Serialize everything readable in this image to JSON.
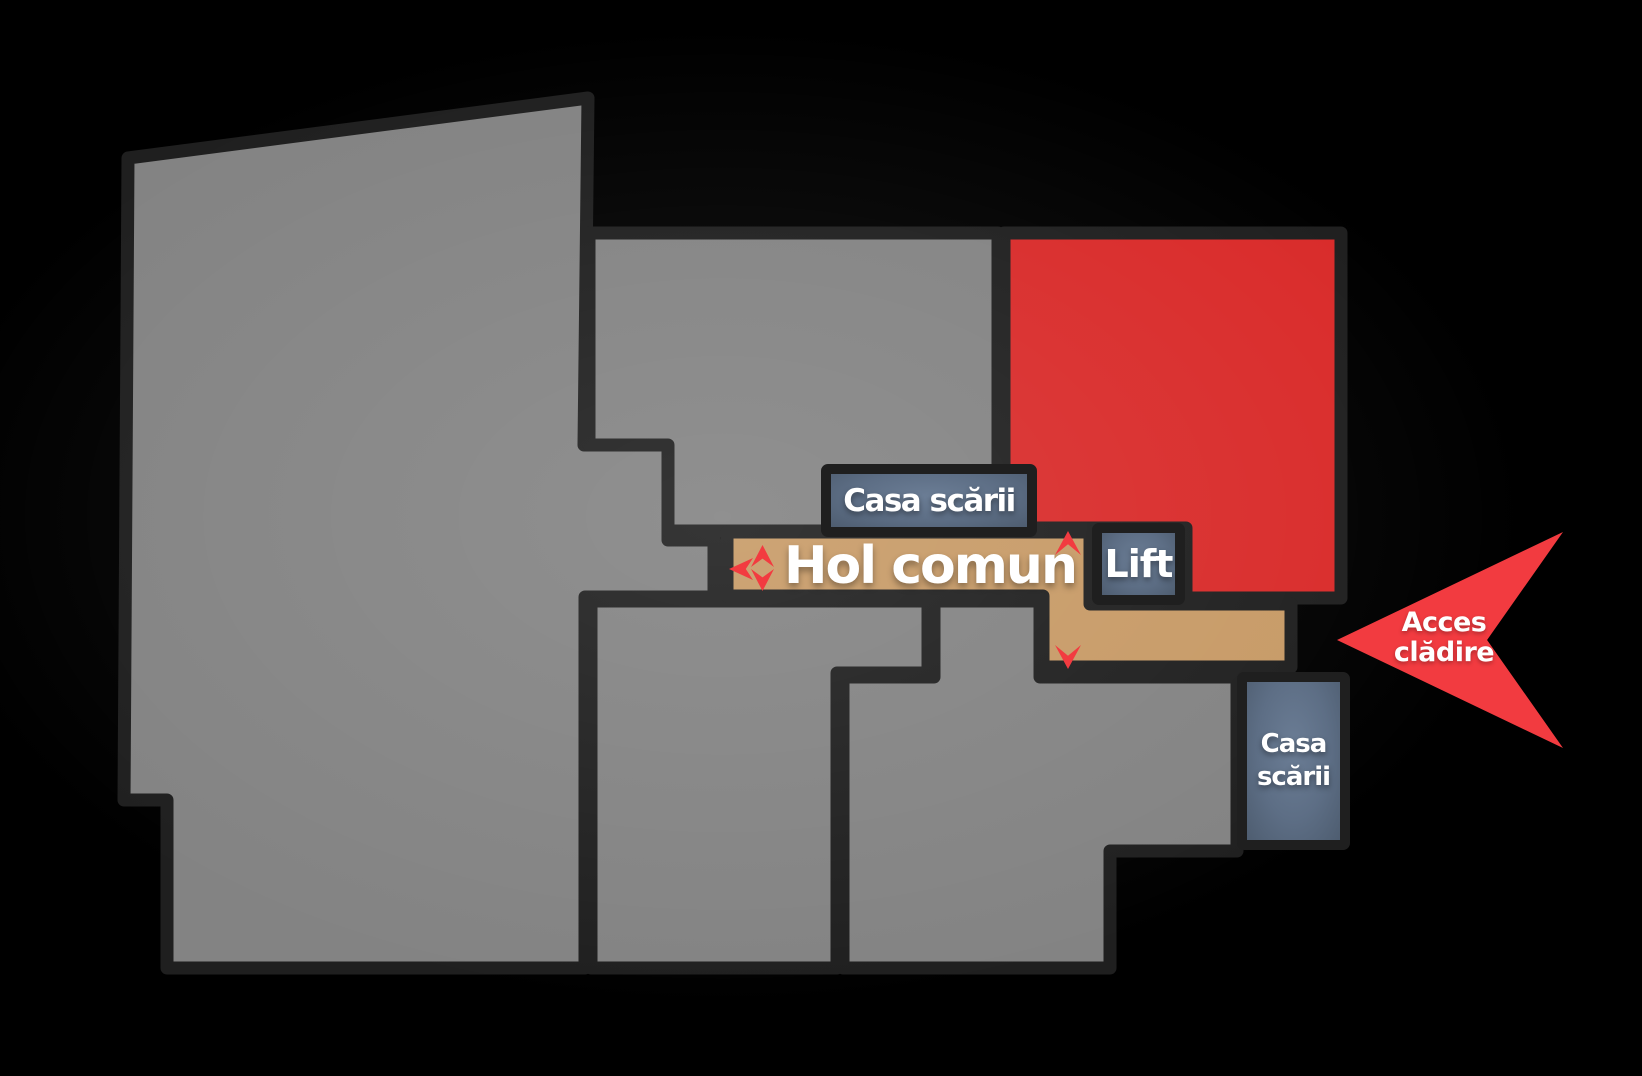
{
  "floorplan": {
    "labels": {
      "staircase_top": "Casa scării",
      "hallway": "Hol comun",
      "lift": "Lift",
      "staircase_bottom_line1": "Casa",
      "staircase_bottom_line2": "scării",
      "access_line1": "Acces",
      "access_line2": "clădire"
    },
    "arrows": {
      "corridor_left_cluster": [
        "left",
        "up",
        "down"
      ],
      "corridor_vertical": [
        "up",
        "down"
      ],
      "building_entrance": "left"
    },
    "colors": {
      "background": "#000000",
      "wall": "#1f1f1f",
      "room_gray": "#838383",
      "room_red": "#d92b2a",
      "hallway_tan": "#c79a66",
      "staircase_slate": "#5d6e85",
      "arrow_red": "#f23b40",
      "text_white": "#ffffff"
    }
  }
}
